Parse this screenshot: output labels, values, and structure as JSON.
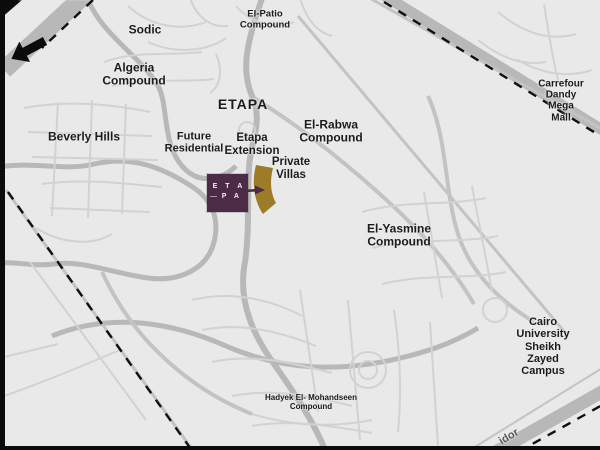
{
  "colors": {
    "map_bg": "#e9e9e9",
    "road_major": "#b8b8b8",
    "road_mid": "#c3c3c3",
    "road_minor": "#d2d2d2",
    "boundary_dash": "#101010",
    "frame": "#0b0b0b",
    "label_text": "#1c1c1c",
    "corridor_text": "#5a5a5a",
    "logo_bg": "#4b2b46",
    "logo_text": "#f3eef2",
    "parcel": "#9c7c28",
    "pointer": "#4b2b46"
  },
  "labels": {
    "desert_road": "Desert Road",
    "sodic": "Sodic",
    "el_patio": "El-Patio\nCompound",
    "algeria": "Algeria\nCompound",
    "etapa": "ETAPA",
    "beverly_hills": "Beverly Hills",
    "future_residential": "Future\nResidential",
    "etapa_extension": "Etapa\nExtension",
    "el_rabwa": "El-Rabwa\nCompound",
    "private_villas": "Private\nVillas",
    "carrefour": "Carrefour Dandy\nMega Mall",
    "el_yasmine": "El-Yasmine\nCompound",
    "cairo_university": "Cairo University\nSheikh Zayed Campus",
    "hadyek": "Hadyek El- Mohandseen\nCompound",
    "corridor": "idor"
  },
  "logo": {
    "line1": "E T A",
    "line2": "P A"
  }
}
